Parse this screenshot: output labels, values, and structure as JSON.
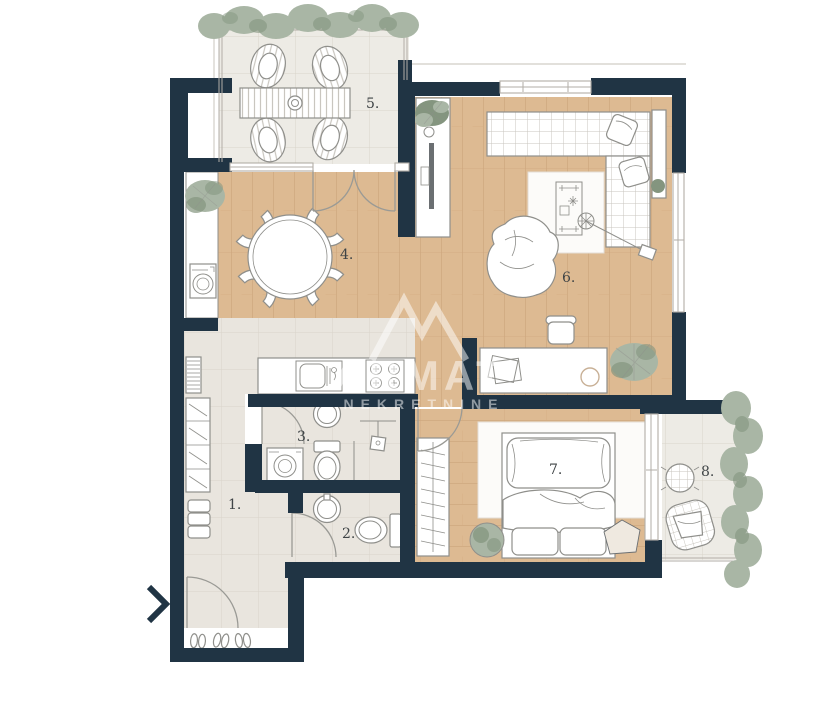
{
  "title": "Apartment floor plan",
  "watermark": {
    "brand": "ARMAT",
    "subtitle": "NEKRETNINE",
    "opacity": "0.5"
  },
  "rooms": [
    {
      "number": "1.",
      "name": "hallway"
    },
    {
      "number": "2.",
      "name": "wc"
    },
    {
      "number": "3.",
      "name": "bathroom"
    },
    {
      "number": "4.",
      "name": "kitchen-dining"
    },
    {
      "number": "5.",
      "name": "terrace"
    },
    {
      "number": "6.",
      "name": "living-room"
    },
    {
      "number": "7.",
      "name": "bedroom"
    },
    {
      "number": "8.",
      "name": "balcony"
    }
  ],
  "colors": {
    "wall": "#203444",
    "wood": "#ddba92",
    "woodLine": "#cda67c",
    "tile": "#edebe5",
    "hallTile": "#e9e5de",
    "tileLine": "#d9d4ca",
    "gridLine": "#c9c6bf",
    "furnStroke": "#8f8f8b",
    "furnDark": "#6b6f72",
    "door": "#9a9a95",
    "winStroke": "#b2aea7",
    "extLine": "#d8d5cf",
    "plant": "#a9b6a5",
    "plantDark": "#84957f",
    "rug": "#fcfbf9",
    "text": "#3f4446"
  }
}
